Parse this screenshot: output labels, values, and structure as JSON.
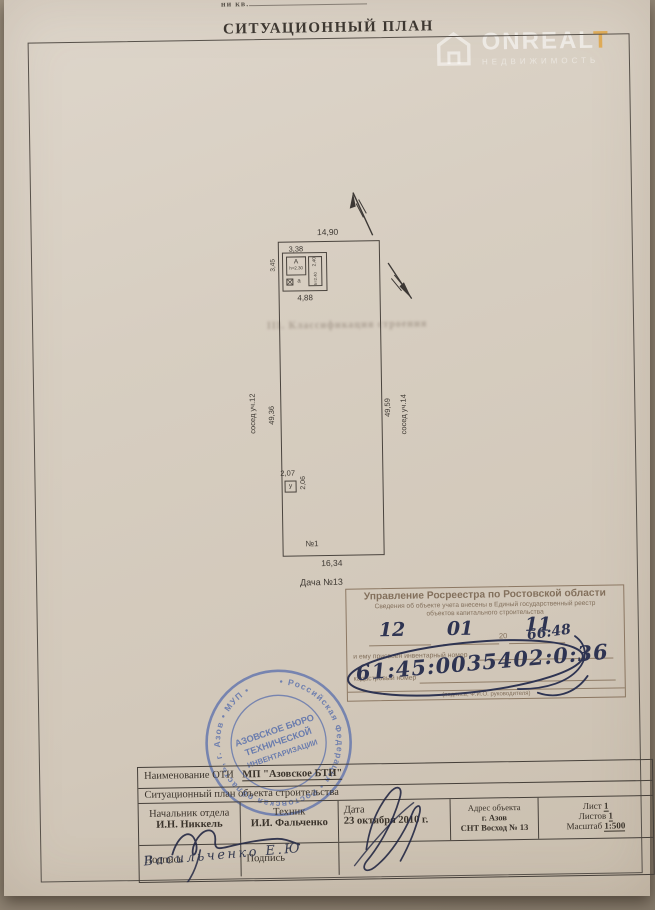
{
  "photo": {
    "top_cut_text": "ни кв."
  },
  "title": "СИТУАЦИОННЫЙ ПЛАН",
  "watermark": {
    "brand_main": "ONREAL",
    "brand_accent": "T",
    "subtitle": "НЕДВИЖИМОСТЬ"
  },
  "bleed_text": "III. Классификация строения",
  "plan": {
    "dim_top": "14,90",
    "left_dim": "49,36",
    "left_neighbor": "сосед уч.12",
    "right_dim": "49,59",
    "right_neighbor": "сосед уч.14",
    "building": {
      "dim_top": "3,38",
      "dim_left": "3,45",
      "dim_bottom": "4,88",
      "dim_right": "2,40",
      "label_main": "А",
      "h_main": "h=2.30",
      "h_annex": "h=2.40",
      "label_annex": "а"
    },
    "shed": {
      "label": "у",
      "dim_top": "2,07",
      "dim_side": "2,06"
    },
    "plot_no": "№1",
    "dim_bottom": "16,34",
    "caption": "Дача №13"
  },
  "reg_stamp": {
    "title": "Управление Росреестра по Ростовской области",
    "line1": "Сведения об объекте учета внесены в Единый государственный реестр",
    "line2": "объектов капитального строительства",
    "date_d": "12",
    "date_m": "01",
    "year_printed": "20",
    "date_y": "11",
    "inv_label": "и ему присвоен инвентарный номер",
    "inv_hand": "66:48",
    "cad_label": "кадастровый номер",
    "cad_hand": "61:45:0035402:0:36",
    "footer": "(подпись, Ф.И.О. руководителя)"
  },
  "seal": {
    "ring_text": "• Российская Федерация • Ростовская область, г. Азов • МУП •",
    "center1": "АЗОВСКОЕ БЮРО",
    "center2": "ТЕХНИЧЕСКОЙ",
    "center3": "ИНВЕНТАРИЗАЦИИ"
  },
  "table": {
    "name_label": "Наименование ОТИ",
    "name_value": "МП \"Азовское БТИ\"",
    "doc_type": "Ситуационный план объекта строительства",
    "chief_title": "Начальник отдела",
    "chief_name": "И.Н. Никкель",
    "tech_title": "Техник",
    "tech_name": "И.И. Фальченко",
    "date_label": "Дата",
    "date_value": "23 октября 2010 г.",
    "addr_label": "Адрес объекта",
    "addr_line1": "г. Азов",
    "addr_line2": "СНТ Восход № 13",
    "sheet_label": "Лист",
    "sheet_value": "1",
    "sheets_label": "Листов",
    "sheets_value": "1",
    "scale_label": "Масштаб",
    "scale_value": "1:500",
    "sign_label": "Подпись"
  },
  "hand_note": "Васильченко Е.Ю"
}
